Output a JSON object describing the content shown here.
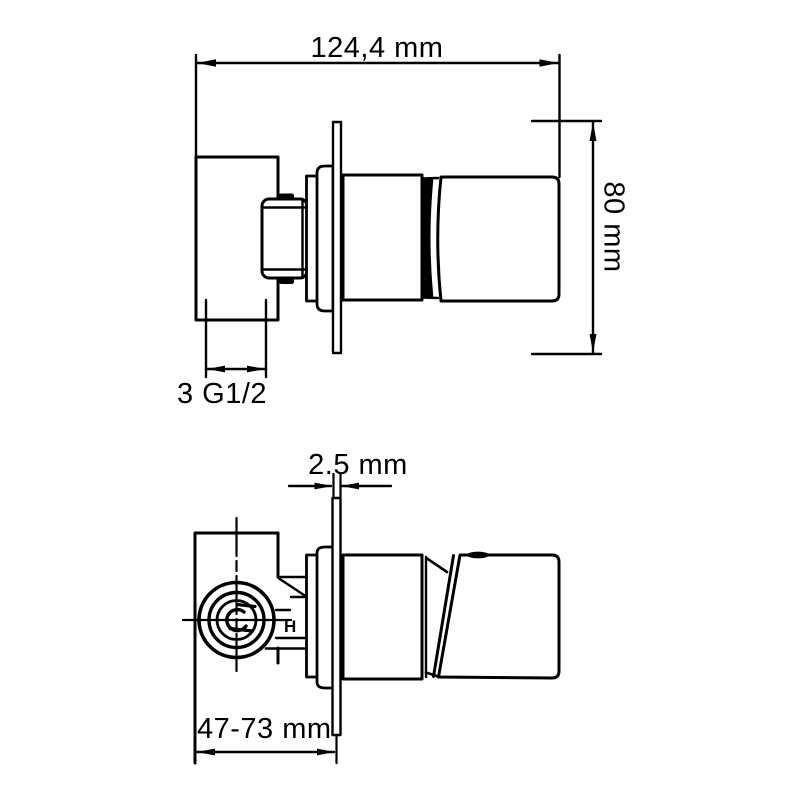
{
  "page": {
    "background": "#ffffff",
    "line_color": "#000000",
    "description": "Technical dimension drawing of a wall-mounted concealed shower mixer valve, side view (top) and top view (bottom)"
  },
  "labels": {
    "overall_width": "124,4 mm",
    "flange_height": "80 mm",
    "thread_size": "3 G1/2",
    "flange_thickness": "2.5 mm",
    "depth_range": "47-73 mm",
    "h_mark": "H"
  }
}
